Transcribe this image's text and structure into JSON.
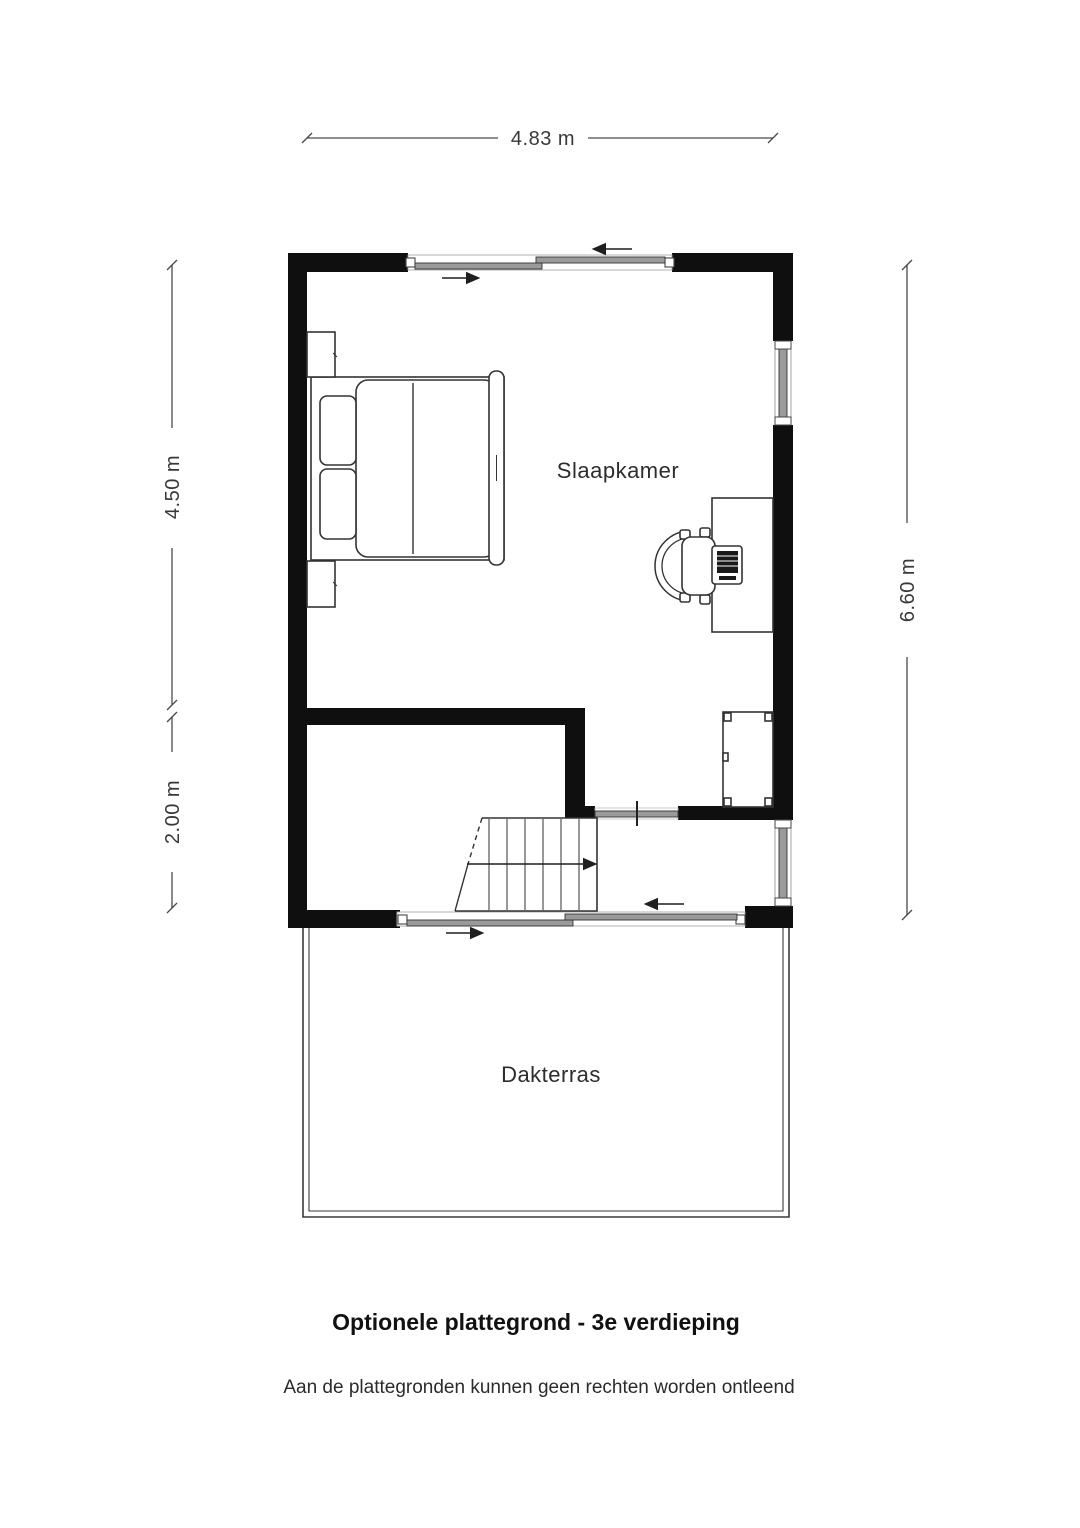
{
  "floorplan": {
    "rooms": {
      "bedroom": {
        "label": "Slaapkamer"
      },
      "terrace": {
        "label": "Dakterras"
      }
    },
    "dimensions": {
      "width_top": "4.83 m",
      "height_bedroom_left": "4.50 m",
      "height_hall_left": "2.00 m",
      "height_total_right": "6.60 m"
    },
    "footer": {
      "title": "Optionele plattegrond - 3e verdieping",
      "disclaimer": "Aan de plattegronden kunnen geen rechten worden ontleend"
    },
    "colors": {
      "wall": "#0f0f0f",
      "glass": "#9a9a9a",
      "outline": "#3a3a3a",
      "dimension": "#383838",
      "background": "#ffffff"
    }
  }
}
